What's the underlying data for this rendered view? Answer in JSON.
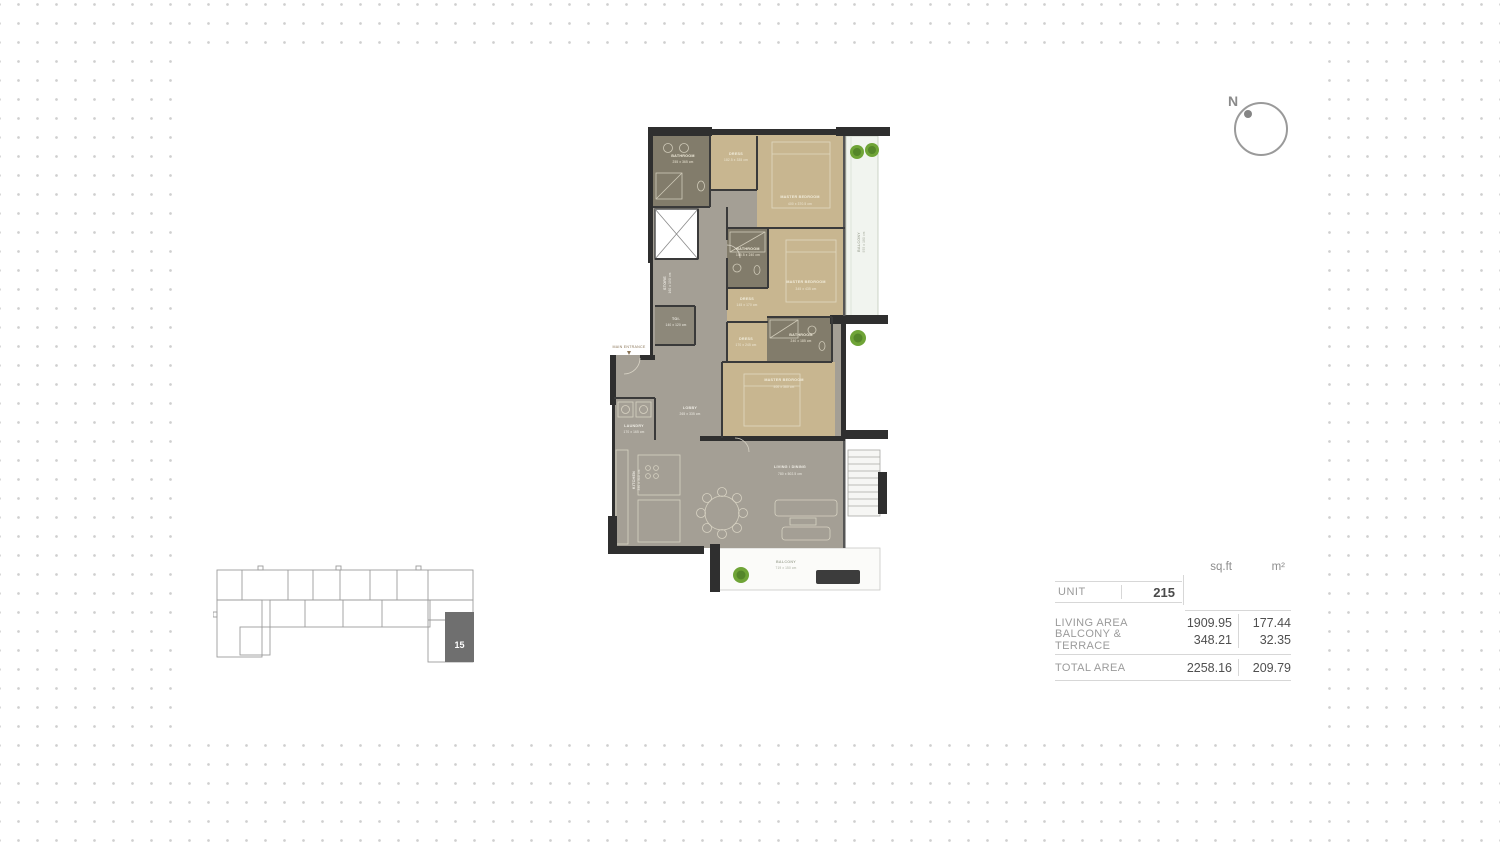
{
  "colors": {
    "wall": "#2f2f2f",
    "bedroom_tan": "#c8b690",
    "bathroom_olive": "#827c6b",
    "floor_gray": "#a49f95",
    "balcony_tint": "#f1f4ef",
    "plant_green": "#6fa437",
    "highlighted_unit_gray": "#6f6f6f",
    "dot_grid": "#cfcfcf"
  },
  "compass": {
    "north_label": "N"
  },
  "floor_plan": {
    "entrance_label": "MAIN ENTRANCE",
    "rooms": [
      {
        "name": "BATHROOM",
        "dims": "255 x 365 cm"
      },
      {
        "name": "DRESS",
        "dims": "182.5 x 335 cm"
      },
      {
        "name": "MASTER BEDROOM",
        "dims": "400 x 370.5 cm"
      },
      {
        "name": "BALCONY",
        "dims": "955 x 180 cm"
      },
      {
        "name": "BATHROOM",
        "dims": "155.5 x 240 cm"
      },
      {
        "name": "DRESS",
        "dims": "145 x 170 cm"
      },
      {
        "name": "MASTER BEDROOM",
        "dims": "345 x 435 cm"
      },
      {
        "name": "STORE",
        "dims": "160 x 190 cm"
      },
      {
        "name": "TOI.",
        "dims": "140 x 120 cm"
      },
      {
        "name": "DRESS",
        "dims": "170 x 245 cm"
      },
      {
        "name": "BATHROOM",
        "dims": "240 x 185 cm"
      },
      {
        "name": "MASTER BEDROOM",
        "dims": "400 x 360 cm"
      },
      {
        "name": "LAUNDRY",
        "dims": "170 x 165 cm"
      },
      {
        "name": "LOBBY",
        "dims": "265 x 335 cm"
      },
      {
        "name": "KITCHEN",
        "dims": "390 x 310 cm"
      },
      {
        "name": "LIVING / DINING",
        "dims": "780 x 502.5 cm"
      },
      {
        "name": "BALCONY",
        "dims": "719 x 150 cm"
      }
    ]
  },
  "key_plan": {
    "unit_label": "15"
  },
  "unit_table": {
    "headers": {
      "sqft": "sq.ft",
      "m2": "m²"
    },
    "unit_label": "UNIT",
    "unit_value": "215",
    "rows": [
      {
        "label": "LIVING AREA",
        "sqft": "1909.95",
        "m2": "177.44"
      },
      {
        "label": "BALCONY & TERRACE",
        "sqft": "348.21",
        "m2": "32.35"
      }
    ],
    "total": {
      "label": "TOTAL AREA",
      "sqft": "2258.16",
      "m2": "209.79"
    }
  }
}
